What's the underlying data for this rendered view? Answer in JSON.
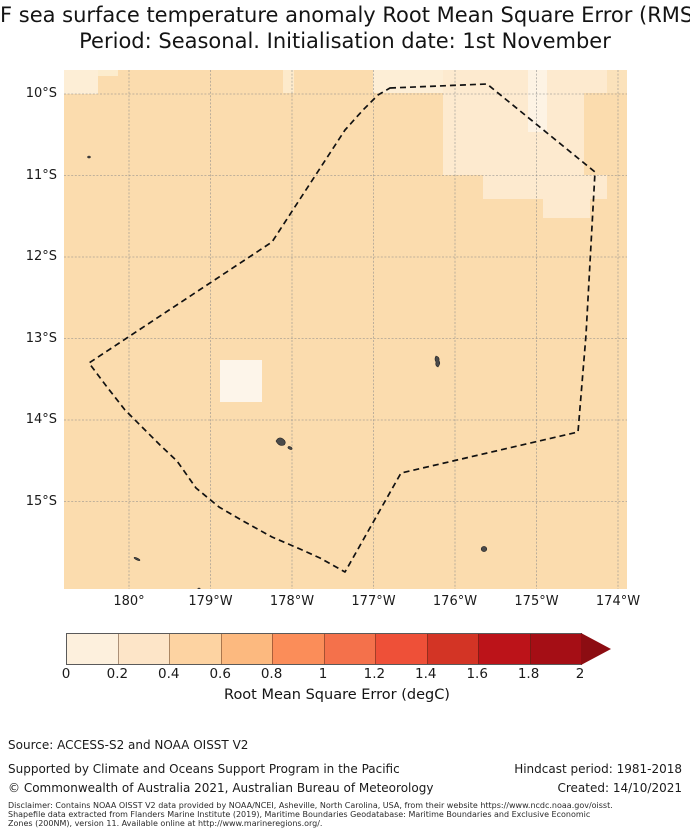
{
  "title": {
    "line1": "F sea surface temperature anomaly Root Mean Square Error (RMSE",
    "line2": "Period: Seasonal. Initialisation date: 1st November"
  },
  "map": {
    "bg_color": "#fbdcae",
    "grid_color": "#8c8c8c",
    "boundary_color": "#111111",
    "island_color": "#4a4a4a",
    "x_ticks": [
      {
        "label": "180°",
        "x": 129
      },
      {
        "label": "179°W",
        "x": 210.5
      },
      {
        "label": "178°W",
        "x": 292
      },
      {
        "label": "177°W",
        "x": 373.5
      },
      {
        "label": "176°W",
        "x": 455
      },
      {
        "label": "175°W",
        "x": 536.5
      },
      {
        "label": "174°W",
        "x": 618
      }
    ],
    "y_ticks": [
      {
        "label": "10°S",
        "y": 94
      },
      {
        "label": "11°S",
        "y": 175.5
      },
      {
        "label": "12°S",
        "y": 257
      },
      {
        "label": "13°S",
        "y": 338.5
      },
      {
        "label": "14°S",
        "y": 420
      },
      {
        "label": "15°S",
        "y": 501.5
      }
    ],
    "boundary_points": [
      [
        390,
        88
      ],
      [
        487,
        84
      ],
      [
        595,
        172
      ],
      [
        586,
        335
      ],
      [
        578,
        432
      ],
      [
        401,
        473
      ],
      [
        345,
        572
      ],
      [
        320,
        558
      ],
      [
        300,
        549
      ],
      [
        272,
        537
      ],
      [
        243,
        521
      ],
      [
        219,
        507
      ],
      [
        196,
        488
      ],
      [
        177,
        461
      ],
      [
        160,
        445
      ],
      [
        143,
        428
      ],
      [
        125,
        410
      ],
      [
        107,
        387
      ],
      [
        89,
        363
      ],
      [
        272,
        242
      ],
      [
        345,
        130
      ],
      [
        363,
        110
      ],
      [
        378,
        95
      ]
    ],
    "patches": [
      {
        "x": 64,
        "y": 70,
        "w": 34,
        "h": 24,
        "color": "#fdeed6"
      },
      {
        "x": 98,
        "y": 70,
        "w": 20,
        "h": 6,
        "color": "#fceccd"
      },
      {
        "x": 283,
        "y": 70,
        "w": 11,
        "h": 23,
        "color": "#fdeacb"
      },
      {
        "x": 373,
        "y": 70,
        "w": 70,
        "h": 23,
        "color": "#fdeed6"
      },
      {
        "x": 443,
        "y": 70,
        "w": 164,
        "h": 23,
        "color": "#fdeacf"
      },
      {
        "x": 443,
        "y": 93,
        "w": 141,
        "h": 82,
        "color": "#fdeacf"
      },
      {
        "x": 528,
        "y": 70,
        "w": 19,
        "h": 62,
        "color": "#fdf3e4"
      },
      {
        "x": 483,
        "y": 175,
        "w": 124,
        "h": 24,
        "color": "#fdeacf"
      },
      {
        "x": 543,
        "y": 199,
        "w": 47,
        "h": 19,
        "color": "#fdeacf"
      },
      {
        "x": 220,
        "y": 360,
        "w": 42,
        "h": 42,
        "color": "#fdf5ea"
      },
      {
        "x": 607,
        "y": 70,
        "w": 20,
        "h": 23,
        "color": "#fbe2bb"
      }
    ],
    "islands": [
      {
        "type": "ellipse",
        "cx": 89,
        "cy": 157,
        "rx": 1.4,
        "ry": 1.0,
        "rot": 0
      },
      {
        "type": "path",
        "d": "M276,441 Q279,436 283,439 Q287,442 284,445 Q279,447 276,441 Z"
      },
      {
        "type": "ellipse",
        "cx": 290,
        "cy": 448,
        "rx": 2.2,
        "ry": 1.2,
        "rot": 25
      },
      {
        "type": "path",
        "d": "M436,356 Q440,357 439,361 Q441,363 438,367 Q435,366 436,362 Q434,359 436,356 Z"
      },
      {
        "type": "ellipse",
        "cx": 484,
        "cy": 549,
        "rx": 2.8,
        "ry": 2.6,
        "rot": 0
      },
      {
        "type": "ellipse",
        "cx": 137,
        "cy": 559,
        "rx": 3.2,
        "ry": 0.9,
        "rot": 25
      },
      {
        "type": "ellipse",
        "cx": 199,
        "cy": 589,
        "rx": 1.2,
        "ry": 1.0,
        "rot": 0
      }
    ]
  },
  "colorbar": {
    "label": "Root Mean Square Error (degC)",
    "tick_labels": [
      "0",
      "0.2",
      "0.4",
      "0.6",
      "0.8",
      "1",
      "1.2",
      "1.4",
      "1.6",
      "1.8",
      "2"
    ],
    "segment_colors": [
      "#fdf0dd",
      "#fde5c8",
      "#fdd3a2",
      "#fcb97f",
      "#fb8d59",
      "#f4714b",
      "#ee5038",
      "#d33425",
      "#bc1319",
      "#a50e15"
    ],
    "arrow_color": "#8c0d12"
  },
  "footer": {
    "source": "Source: ACCESS-S2 and NOAA OISST V2",
    "supported": "Supported by Climate and Oceans Support Program in the Pacific",
    "copyright": "© Commonwealth of Australia 2021, Australian Bureau of Meteorology",
    "hindcast": "Hindcast period: 1981-2018",
    "created": "Created: 14/10/2021",
    "disclaimer_lines": [
      "Disclaimer: Contains NOAA OISST V2 data provided by NOAA/NCEI, Asheville, North Carolina, USA, from their website https://www.ncdc.noaa.gov/oisst.",
      "Shapefile data extracted from Flanders Marine Institute (2019), Maritime Boundaries Geodatabase: Maritime Boundaries and Exclusive Economic",
      "Zones (200NM), version 11. Available online at http://www.marineregions.org/."
    ]
  },
  "chart_data": {
    "type": "heatmap",
    "title": "F sea surface temperature anomaly Root Mean Square Error (RMSE",
    "subtitle": "Period: Seasonal. Initialisation date: 1st November",
    "x_tick_labels": [
      "180°",
      "179°W",
      "178°W",
      "177°W",
      "176°W",
      "175°W",
      "174°W"
    ],
    "y_tick_labels": [
      "10°S",
      "11°S",
      "12°S",
      "13°S",
      "14°S",
      "15°S"
    ],
    "x_range_approx": [
      "179.2°E",
      "173.9°W"
    ],
    "y_range_approx": [
      "9.7°S",
      "16.1°S"
    ],
    "colorbar_label": "Root Mean Square Error (degC)",
    "colorbar_ticks": [
      0,
      0.2,
      0.4,
      0.6,
      0.8,
      1,
      1.2,
      1.4,
      1.6,
      1.8,
      2
    ],
    "colorbar_extend": "max",
    "grid": true,
    "legend_position": "bottom colorbar",
    "values_summary": {
      "dominant_rmse_bin": [
        0.4,
        0.6
      ],
      "lighter_patch_bins": [
        [
          0,
          0.2
        ],
        [
          0.2,
          0.4
        ]
      ],
      "lighter_patch_locations": [
        "north-east corner of domain (175°W–174°W, 10°S–11.5°S)",
        "top edge near 177°W–176°W",
        "cell near 179.3°W 13.5°S",
        "top-left corner cell near 180° 9.8°S"
      ],
      "overlays": [
        "dashed EEZ boundary polygon",
        "small dark islands near 178°W 14.3°S, 176.2°W 13.3°S, 175.7°W 15.6°S, 180° 15.7°S"
      ]
    }
  }
}
